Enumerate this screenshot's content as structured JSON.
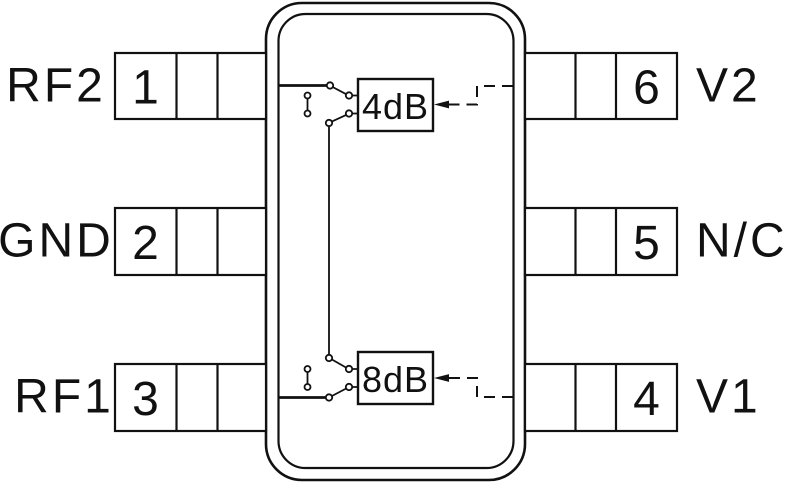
{
  "diagram": {
    "kind": "ic-pinout-functional-diagram",
    "colors": {
      "background": "#ffffff",
      "line": "#111111"
    },
    "pins": [
      {
        "number": "1",
        "label": "RF2",
        "side": "left"
      },
      {
        "number": "2",
        "label": "GND",
        "side": "left"
      },
      {
        "number": "3",
        "label": "RF1",
        "side": "left"
      },
      {
        "number": "4",
        "label": "V1",
        "side": "right"
      },
      {
        "number": "5",
        "label": "N/C",
        "side": "right"
      },
      {
        "number": "6",
        "label": "V2",
        "side": "right"
      }
    ],
    "blocks": [
      {
        "label": "4dB"
      },
      {
        "label": "8dB"
      }
    ]
  }
}
